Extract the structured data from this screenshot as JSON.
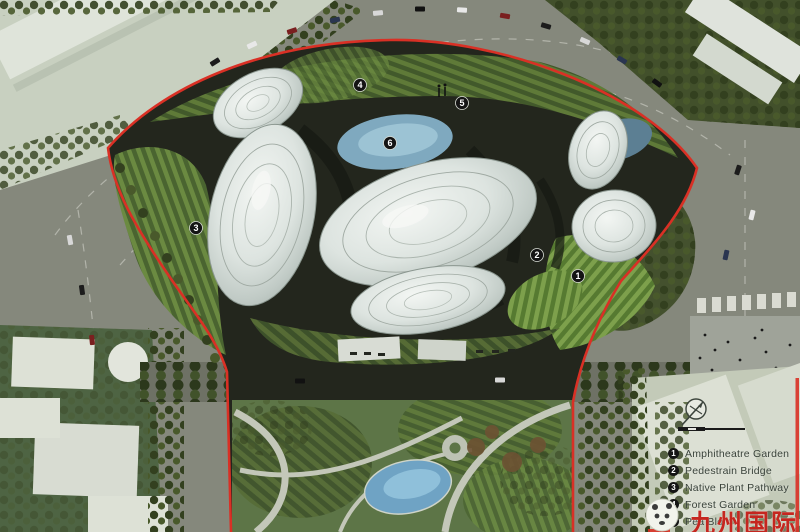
{
  "legend": {
    "items": [
      {
        "num": "1",
        "label": "Amphitheatre Garden"
      },
      {
        "num": "2",
        "label": "Pedestrain Bridge"
      },
      {
        "num": "3",
        "label": "Native Plant Pathway"
      },
      {
        "num": "4",
        "label": "Forest Garden"
      },
      {
        "num": "5",
        "label": "Pea Blo n"
      }
    ]
  },
  "plan_markers": [
    {
      "num": "1",
      "x": 578,
      "y": 276
    },
    {
      "num": "2",
      "x": 537,
      "y": 255
    },
    {
      "num": "3",
      "x": 196,
      "y": 228
    },
    {
      "num": "4",
      "x": 360,
      "y": 85
    },
    {
      "num": "5",
      "x": 462,
      "y": 103
    },
    {
      "num": "6",
      "x": 390,
      "y": 143
    }
  ],
  "watermark": {
    "text": "九州国际",
    "color": "#c5261f"
  },
  "colors": {
    "site_boundary": "#d93025",
    "silver_building": "#dde4e0",
    "pond_blue": "#7fa9bf",
    "landscape_green": "#5d7547",
    "road_grey": "#85887c",
    "marker_badge": "#141414"
  }
}
